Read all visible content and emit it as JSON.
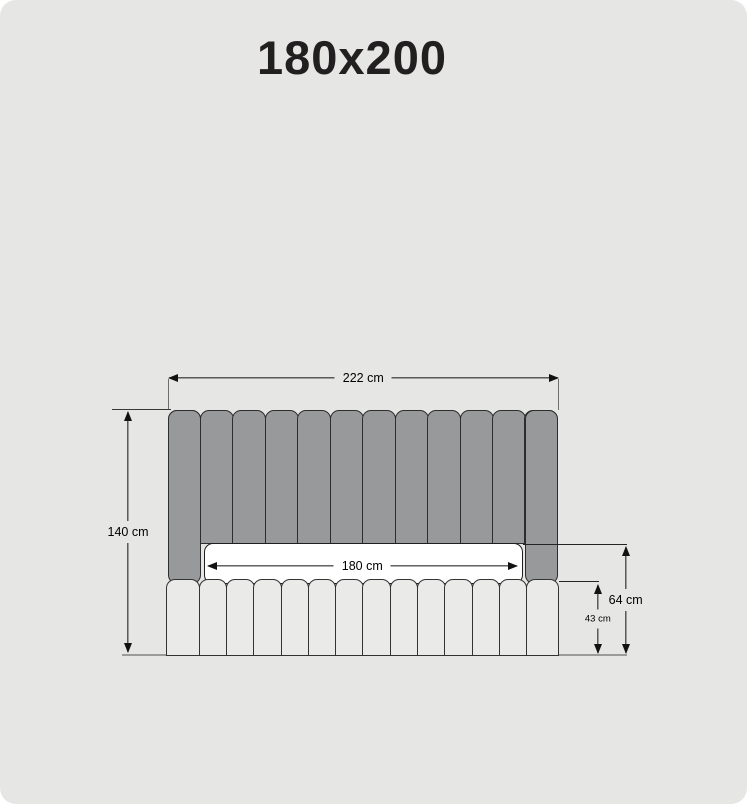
{
  "title": "180x200",
  "colors": {
    "card_bg": "#e6e6e5",
    "page_bg": "#ffffff",
    "headboard_fill": "#98999b",
    "headboard_border": "#2e2d2d",
    "base_fill": "#eaeae9",
    "base_border": "#333333",
    "mattress_fill": "#ffffff",
    "mattress_border": "#1f1f1f",
    "dim_color": "#121212",
    "title_color": "#221f20"
  },
  "diagram": {
    "headboard": {
      "slat_count": 12
    },
    "base": {
      "slat_count": 14
    },
    "dimensions": {
      "width_total": "222 cm",
      "height_total": "140 cm",
      "width_mattress": "180 cm",
      "height_back": "64 cm",
      "height_base": "43 cm"
    }
  }
}
